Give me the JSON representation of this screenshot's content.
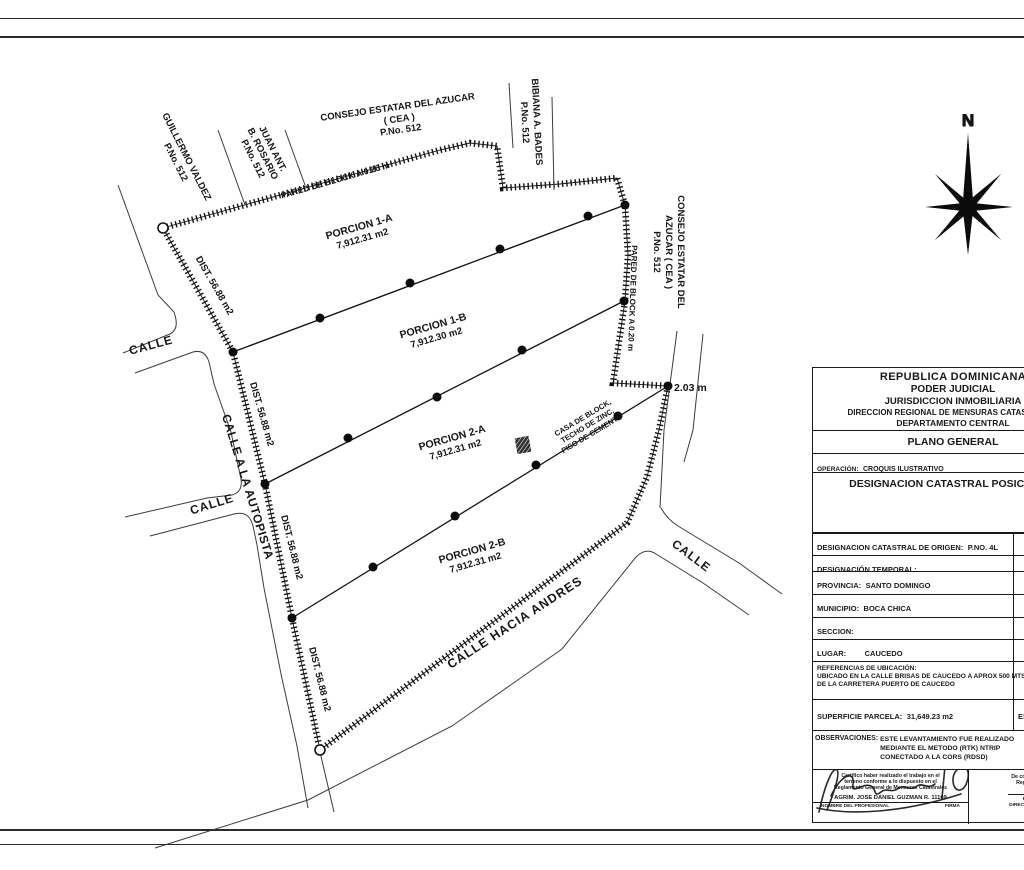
{
  "plot": {
    "north": "N",
    "neighbors": {
      "guillermo": [
        "GUILLERMO VALDEZ",
        "P.No. 512"
      ],
      "juan": [
        "JUAN ANT.",
        "B. ROSARIO",
        "P.No. 512"
      ],
      "consejo_top": [
        "CONSEJO ESTATAR DEL AZUCAR",
        "( CEA )",
        "P.No. 512"
      ],
      "bibiana": [
        "BIBIANA A. BADES",
        "P.No. 512"
      ],
      "consejo_right": [
        "CONSEJO ESTATAR DEL",
        "AZUCAR ( CEA )",
        "P.No. 512"
      ]
    },
    "walls": {
      "top": "PARED DE BLOCK A 0.20 m",
      "right": "PARED DE BLOCK A 0.20 m"
    },
    "parcels": [
      {
        "name": "PORCION 1-A",
        "area": "7,912.31 m2"
      },
      {
        "name": "PORCION 1-B",
        "area": "7,912.30 m2"
      },
      {
        "name": "PORCION 2-A",
        "area": "7,912.31 m2"
      },
      {
        "name": "PORCION 2-B",
        "area": "7,912.31 m2"
      }
    ],
    "distances": [
      "DIST. 56.88 m2",
      "DIST. 56.88 m2",
      "DIST. 56.88 m2",
      "DIST. 56.88 m2"
    ],
    "measure": "2.03 m",
    "house": [
      "CASA DE BLOCK,",
      "TECHO DE ZINC,",
      "PISO DE CEMENTO"
    ],
    "roads": {
      "calle_nw": "CALLE",
      "calle_w": "CALLE",
      "calle_e": "CALLE",
      "autopista": "CALLE A LA AUTOPISTA",
      "hacia_andres": "CALLE HACIA ANDRES"
    }
  },
  "titleblock": {
    "header": [
      "REPUBLICA DOMINICANA",
      "PODER JUDICIAL",
      "JURISDICCION INMOBILIARIA",
      "DIRECCION REGIONAL DE MENSURAS CATASTRALES",
      "DEPARTAMENTO CENTRAL"
    ],
    "plano": "PLANO GENERAL",
    "operacion_label": "OPERACIÓN:",
    "operacion_value": "CROQUIS ILUSTRATIVO",
    "designacion_posicional": "DESIGNACION CATASTRAL POSICIONAL",
    "origen_label": "DESIGNACION CATASTRAL DE ORIGEN:",
    "origen_value": "P.NO. 4L",
    "temporal_label": "DESIGNACIÓN TEMPORAL:",
    "provincia_label": "PROVINCIA:",
    "provincia_value": "SANTO DOMINGO",
    "municipio_label": "MUNICIPIO:",
    "municipio_value": "BOCA CHICA",
    "seccion_label": "SECCION:",
    "lugar_label": "LUGAR:",
    "lugar_value": "CAUCEDO",
    "referencias_label": "REFERENCIAS DE UBICACIÓN:",
    "referencias_line1": "UBICADO EN LA CALLE BRISAS DE CAUCEDO A APROX 500 MTS",
    "referencias_line2": "DE LA CARRETERA PUERTO DE CAUCEDO",
    "superficie_label": "SUPERFICIE PARCELA:",
    "superficie_value": "31,649.23 m2",
    "escala_label": "ESCALA",
    "observaciones_label": "OBSERVACIONES:",
    "observaciones_line1": "ESTE LEVANTAMIENTO FUE REALIZADO",
    "observaciones_line2": "MEDIANTE EL METODO (RTK) NTRIP",
    "observaciones_line3": "CONECTADO A LA CORS (RDSD)",
    "cert_line1": "Certifico haber realizado el trabajo en el",
    "cert_line2": "terreno conforme a lo dispuesto en el",
    "cert_line3": "Reglamento General de Mensuras Catastrales",
    "surveyor": "AGRIM. JOSE DANIEL GUZMAN R. 11109",
    "nombre_label": "NOMBRE DEL PROFESIONAL",
    "firma_label": "FIRMA",
    "conformidad_line1": "De conformidad",
    "conformidad_line2": "Reglamento",
    "fecha_label": "FECHA",
    "direccion_label": "DIRECCION REGIO"
  }
}
